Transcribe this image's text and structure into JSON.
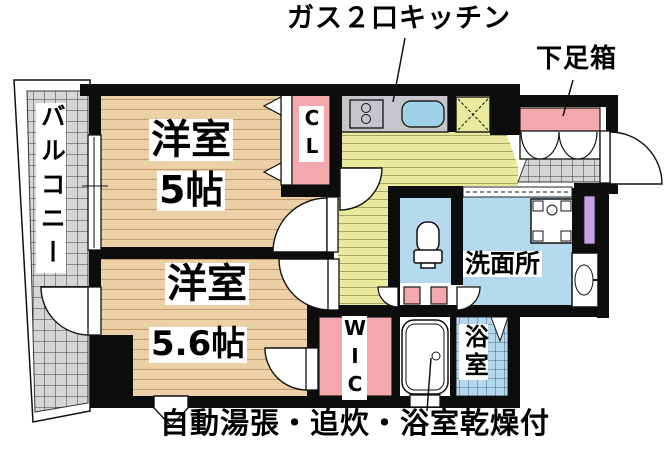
{
  "title_callouts": {
    "kitchen": "ガス２口キッチン",
    "shoe_cabinet": "下足箱"
  },
  "rooms": {
    "balcony": {
      "label": "バルコニー"
    },
    "room_a": {
      "name": "洋室",
      "size": "5帖"
    },
    "room_b": {
      "name": "洋室",
      "size": "5.6帖"
    },
    "closet": {
      "label": "CL"
    },
    "walk_in_closet": {
      "label": "WIC"
    },
    "washroom": {
      "label": "洗面所"
    },
    "bathroom": {
      "label": "浴室"
    }
  },
  "notes": {
    "features": "自動湯張・追炊・浴室乾燥付"
  },
  "colors": {
    "wall": "#0d0d0d",
    "wood_floor": "#ecd0a6",
    "kitchen_floor": "#e9ea9e",
    "tile_gray": "#d6d6d6",
    "water_blue": "#b5d9ec",
    "closet_pink": "#f2a8ad",
    "storage_purple": "#c9a2e6",
    "sink_blue": "#9fd2e8",
    "counter_gray": "#c6c6ca"
  }
}
